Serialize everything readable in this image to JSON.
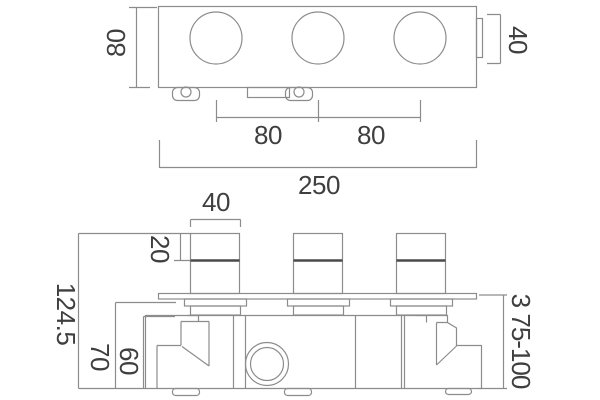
{
  "drawing": {
    "name": "thermostatic-shower-valve-dimension-drawing",
    "colors": {
      "background": "#ffffff",
      "line": "#8c8c8c",
      "dark_line": "#4a4a4a",
      "text": "#3f3f3f"
    },
    "top_view": {
      "body_depth_label": "80",
      "side_tab_label": "40",
      "hole_spacing_labels": [
        "80",
        "80"
      ],
      "overall_width_label": "250"
    },
    "front_view": {
      "handle_width_label": "40",
      "handle_cap_height_label": "20",
      "overall_height_label": "124.5",
      "plate_to_base_label": "70",
      "body_height_label": "60",
      "fixing_depth_range_label": "3 75-100"
    }
  }
}
